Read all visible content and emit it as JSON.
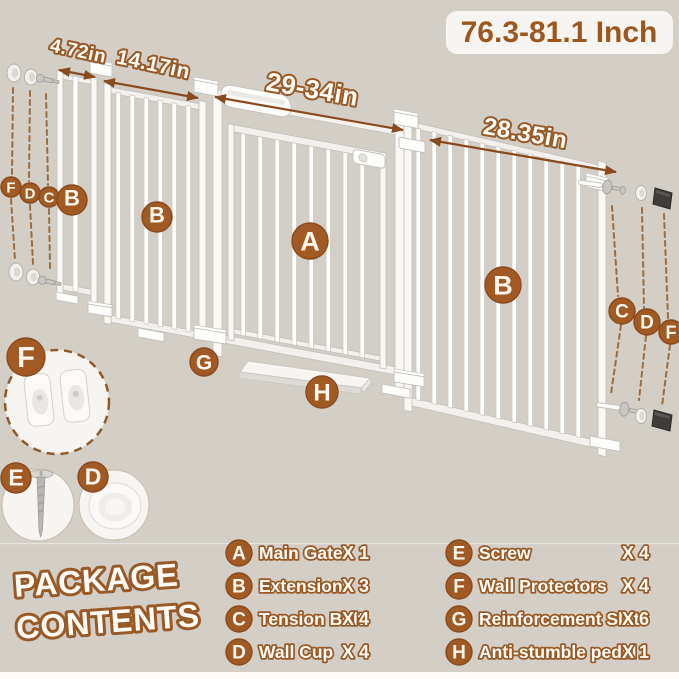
{
  "size_range_label": "76.3-81.1 Inch",
  "dimension_labels": {
    "small_extension": "4.72in",
    "medium_extension": "14.17in",
    "main_gate": "29-34in",
    "large_extension": "28.35in"
  },
  "badges": {
    "main_gate": "A",
    "extension": "B",
    "tension_bolt": "C",
    "wall_cup": "D",
    "screw": "E",
    "wall_protectors": "F",
    "reinforcement_slot": "G",
    "anti_stumble_pedal": "H"
  },
  "package_contents": {
    "title_line1": "PACKAGE",
    "title_line2": "CONTENTS",
    "items": [
      {
        "badge": "A",
        "label": "Main Gate",
        "qty": "X 1"
      },
      {
        "badge": "B",
        "label": "Extension",
        "qty": "X 3"
      },
      {
        "badge": "C",
        "label": "Tension Bolt",
        "qty": "X 4"
      },
      {
        "badge": "D",
        "label": "Wall Cup",
        "qty": "X 4"
      },
      {
        "badge": "E",
        "label": "Screw",
        "qty": "X 4"
      },
      {
        "badge": "F",
        "label": "Wall Protectors",
        "qty": "X 4"
      },
      {
        "badge": "G",
        "label": "Reinforcement Slot",
        "qty": "X 6"
      },
      {
        "badge": "H",
        "label": "Anti-stumble pedal",
        "qty": "X 1"
      }
    ]
  },
  "colors": {
    "background": "#d3cfc7",
    "accent_brown": "#a15a24",
    "outline_brown": "#9a5a28",
    "label_box_bg": "#f7f5f1",
    "gate_white": "#fcfcfb",
    "dark_hardware": "#3f3d3a"
  }
}
